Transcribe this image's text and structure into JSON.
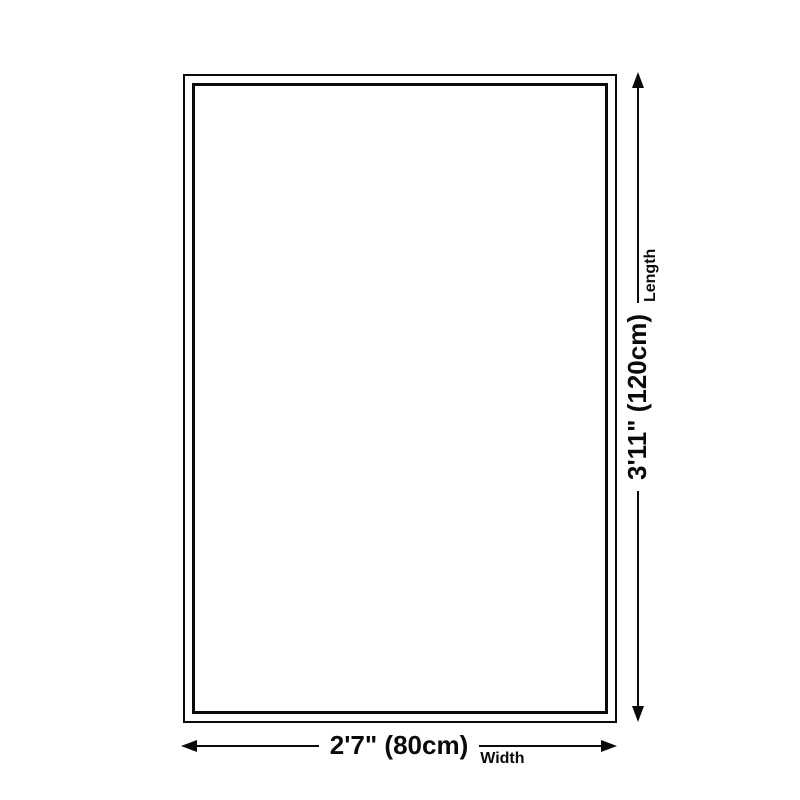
{
  "canvas": {
    "background_color": "#ffffff",
    "line_color": "#0a0a0a"
  },
  "rug": {
    "shape": "rectangle",
    "border_style": "double"
  },
  "dimensions": {
    "length": {
      "value": "3'11\" (120cm)",
      "label": "Length",
      "orientation": "vertical"
    },
    "width": {
      "value": "2'7\" (80cm)",
      "label": "Width",
      "orientation": "horizontal"
    }
  }
}
